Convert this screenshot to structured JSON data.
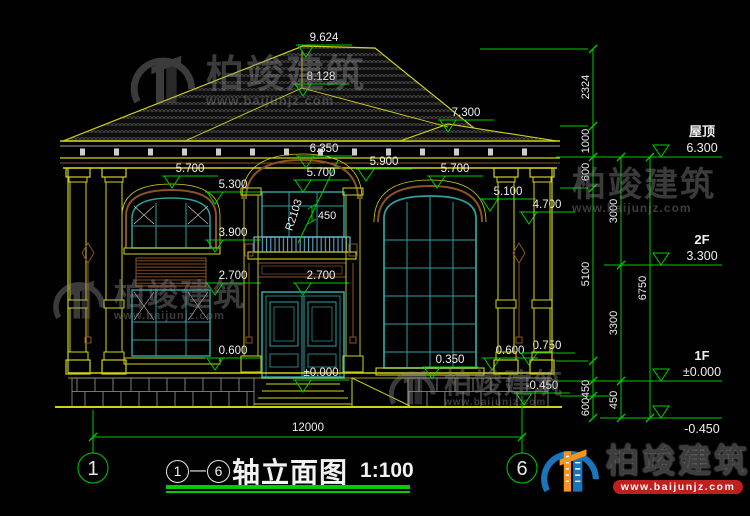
{
  "drawing": {
    "elevation_markers": [
      {
        "label": "9.624",
        "x": 306,
        "y": 57
      },
      {
        "label": "8.128",
        "x": 303,
        "y": 96
      },
      {
        "label": "7.300",
        "x": 448,
        "y": 132
      },
      {
        "label": "6.350",
        "x": 306,
        "y": 168
      },
      {
        "label": "5.700",
        "x": 172,
        "y": 188
      },
      {
        "label": "5.300",
        "x": 215,
        "y": 204
      },
      {
        "label": "5.700",
        "x": 303,
        "y": 192
      },
      {
        "label": "5.900",
        "x": 366,
        "y": 181
      },
      {
        "label": "5.700",
        "x": 437,
        "y": 188
      },
      {
        "label": "5.100",
        "x": 490,
        "y": 211
      },
      {
        "label": "4.700",
        "x": 529,
        "y": 224
      },
      {
        "label": "3.900",
        "x": 215,
        "y": 252
      },
      {
        "label": "2.700",
        "x": 215,
        "y": 295
      },
      {
        "label": "2.700",
        "x": 303,
        "y": 295
      },
      {
        "label": "0.600",
        "x": 215,
        "y": 370
      },
      {
        "label": "±0.000",
        "x": 303,
        "y": 392
      },
      {
        "label": "0.350",
        "x": 432,
        "y": 379
      },
      {
        "label": "0.600",
        "x": 492,
        "y": 370
      },
      {
        "label": "0.750",
        "x": 529,
        "y": 365
      },
      {
        "label": "-0.450",
        "x": 524,
        "y": 405
      }
    ],
    "annotations": [
      {
        "t": "R2103",
        "x": 297,
        "y": 216,
        "r": -72
      },
      {
        "t": "450",
        "x": 327,
        "y": 219,
        "r": 0
      }
    ],
    "dim_chains": [
      {
        "x": 593,
        "y1": 49,
        "y2": 418,
        "ticks": [
          49,
          126,
          157,
          188,
          361,
          381,
          396,
          418
        ],
        "dims": [
          {
            "v": "2324",
            "y": 87
          },
          {
            "v": "1000",
            "y": 141
          },
          {
            "v": "600",
            "y": 172
          },
          {
            "v": "5100",
            "y": 274
          },
          {
            "v": "450",
            "y": 389
          },
          {
            "v": "600",
            "y": 407
          }
        ]
      },
      {
        "x": 621,
        "y1": 157,
        "y2": 418,
        "ticks": [
          157,
          265,
          381,
          418
        ],
        "dims": [
          {
            "v": "3000",
            "y": 211
          },
          {
            "v": "3300",
            "y": 323
          },
          {
            "v": "450",
            "y": 400
          }
        ]
      },
      {
        "x": 650,
        "y1": 157,
        "y2": 418,
        "ticks": [
          157,
          418
        ],
        "dims": [
          {
            "v": "6750",
            "y": 288
          }
        ]
      }
    ],
    "floor_levels": [
      {
        "name": "屋顶",
        "value": "6.300",
        "y": 157,
        "below": false
      },
      {
        "name": "2F",
        "value": "3.300",
        "y": 265,
        "below": false
      },
      {
        "name": "1F",
        "value": "±0.000",
        "y": 381,
        "below": false
      },
      {
        "name": "",
        "value": "-0.450",
        "y": 418,
        "below": true
      }
    ],
    "bottom": {
      "total_width": "12000",
      "axis_left": "1",
      "axis_right": "6"
    }
  },
  "title": {
    "axis_from": "1",
    "separator": "—",
    "axis_to": "6",
    "text": "轴立面图",
    "scale": "1:100"
  },
  "watermark": {
    "brand": "柏竣建筑",
    "url": "www.baijunjz.com"
  },
  "logo": {
    "brand": "柏竣建筑",
    "url": "www.baijunjz.com"
  }
}
